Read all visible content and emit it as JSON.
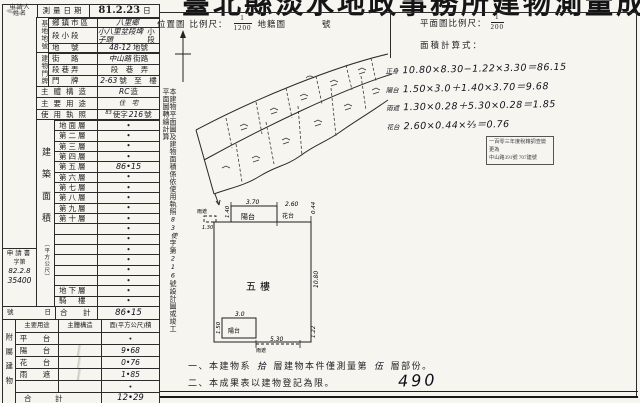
{
  "title": "臺北縣淡水地政事務所建物測量成果圖",
  "header": {
    "location_label": "位置圖",
    "scale_label": "比例尺：",
    "loc_num": "1",
    "loc_den": "1200",
    "cadastral_label": "地籍圖",
    "sheet_label": "號",
    "plan_scale_label": "平面圖比例尺：",
    "plan_num": "1",
    "plan_den": "200",
    "calc_label": "面積計算式："
  },
  "info": {
    "applicant_line1": "申請人",
    "applicant_line2": "姓名",
    "date_label": "測量日期",
    "date_value": "81.2.23",
    "date_suffix": "日",
    "site_group": "基地地號",
    "door_group": "建物門牌",
    "site_rows": [
      {
        "label": "鄉鎮市區",
        "value": "八里鄉",
        "suffix": ""
      },
      {
        "label": "段小段",
        "value": "小八里坌段埤子頭",
        "suffix": "小段"
      },
      {
        "label": "地　號",
        "value": "48-12",
        "suffix": "地號"
      }
    ],
    "door_rows": [
      {
        "label": "街　路",
        "value": "中山路",
        "suffix": "街路"
      },
      {
        "label": "段巷弄",
        "value": "",
        "suffix": "段　巷　弄"
      },
      {
        "label": "門　牌",
        "value": "2-63",
        "suffix": "號　至　樓"
      }
    ],
    "structure_label": "主體構造",
    "structure_value": "RC",
    "structure_suffix": "造",
    "usage_label": "主要用途",
    "usage_value": "住　宅",
    "license_label": "使用執照",
    "license_pre": "83",
    "license_mid": "使字",
    "license_no": "216",
    "license_suffix": "號"
  },
  "floors": {
    "group_label": "建築面積",
    "group_unit": "（平方公尺）",
    "rows": [
      {
        "label": "地面層",
        "value": "•",
        "vcls": "dot"
      },
      {
        "label": "第二層",
        "value": "•",
        "vcls": "dot"
      },
      {
        "label": "第三層",
        "value": "•",
        "vcls": "dot"
      },
      {
        "label": "第四層",
        "value": "•",
        "vcls": "dot"
      },
      {
        "label": "第五層",
        "value": "86•15",
        "vcls": "hand"
      },
      {
        "label": "第六層",
        "value": "•",
        "vcls": "dot"
      },
      {
        "label": "第七層",
        "value": "•",
        "vcls": "dot"
      },
      {
        "label": "第八層",
        "value": "•",
        "vcls": "dot"
      },
      {
        "label": "第九層",
        "value": "•",
        "vcls": "dot"
      },
      {
        "label": "第十層",
        "value": "•",
        "vcls": "dot"
      },
      {
        "label": "",
        "value": "•",
        "vcls": "dot"
      },
      {
        "label": "",
        "value": "•",
        "vcls": "dot"
      },
      {
        "label": "",
        "value": "•",
        "vcls": "dot"
      },
      {
        "label": "",
        "value": "•",
        "vcls": "dot"
      },
      {
        "label": "",
        "value": "•",
        "vcls": "dot"
      },
      {
        "label": "",
        "value": "•",
        "vcls": "dot"
      },
      {
        "label": "地下層",
        "value": "•",
        "vcls": "dot"
      },
      {
        "label": "騎　樓",
        "value": "•",
        "vcls": "dot"
      }
    ],
    "total_prefix_no": "號",
    "total_prefix_day": "日",
    "total_label": "合　計",
    "total_value": "86•15"
  },
  "application": {
    "label": "申請書",
    "no_label": "字第",
    "date": "82.2.8",
    "number": "35400"
  },
  "attached": {
    "group_label": "附屬建物",
    "headers": [
      "主要用途",
      "主體構造",
      "面(平方公尺)積"
    ],
    "rows": [
      {
        "use": "平　台",
        "mkcls": "",
        "area": "•",
        "acls": "dot"
      },
      {
        "use": "陽　台",
        "mkcls": "mk",
        "area": "9•68",
        "acls": "hand"
      },
      {
        "use": "花　台",
        "mkcls": "mk",
        "area": "0•76",
        "acls": "hand"
      },
      {
        "use": "雨　遮",
        "mkcls": "mk",
        "area": "1•85",
        "acls": "hand"
      },
      {
        "use": "",
        "mkcls": "",
        "area": "•",
        "acls": "dot"
      }
    ],
    "total_label": "合　計",
    "total_value": "12•29"
  },
  "side_note": {
    "pre": "本建物平面圖及建物面積係依使用執照",
    "hand1": "83使",
    "mid": "字第",
    "hand2": "216",
    "post": "號設計圖或竣工平面圖轉繪計算"
  },
  "calc": {
    "lines": [
      {
        "label": "正身",
        "text": "10.80×8.30−1.22×3.30＝86.15"
      },
      {
        "label": "陽台",
        "text": "1.50×3.0＋1.40×3.70＝9.68"
      },
      {
        "label": "雨遮",
        "text": "1.30×0.28＋5.30×0.28＝1.85"
      },
      {
        "label": "花台",
        "text": "2.60×0.44×⅔＝0.76"
      }
    ]
  },
  "stamp": {
    "line1": "一百零三年度稅籍調查變更為",
    "line2": "中山路391號 707建號"
  },
  "plan": {
    "center": "五樓",
    "top_balcony": "陽台",
    "top_balcony_w": "3.70",
    "top_balcony_d": "1.40",
    "left_canopy": "雨遮",
    "left_canopy_w": "1.30",
    "flower": "花台",
    "flower_w": "2.60",
    "flower_d": "0.44",
    "right_dim": "10.80",
    "bot_balcony": "陽台",
    "bot_balcony_w": "3.0",
    "bot_balcony_d": "1.50",
    "bot_canopy": "雨遮",
    "bot_canopy_w": "5.30",
    "corner_dim": "1.22"
  },
  "notes": {
    "n1_prefix": "一、本建物系",
    "n1_hand1": "拾",
    "n1_mid": "層建物本件僅測量第",
    "n1_hand2": "伍",
    "n1_suffix": "層部份。",
    "n2": "二、本成果表以建物登記為限。",
    "page_number": "490"
  }
}
